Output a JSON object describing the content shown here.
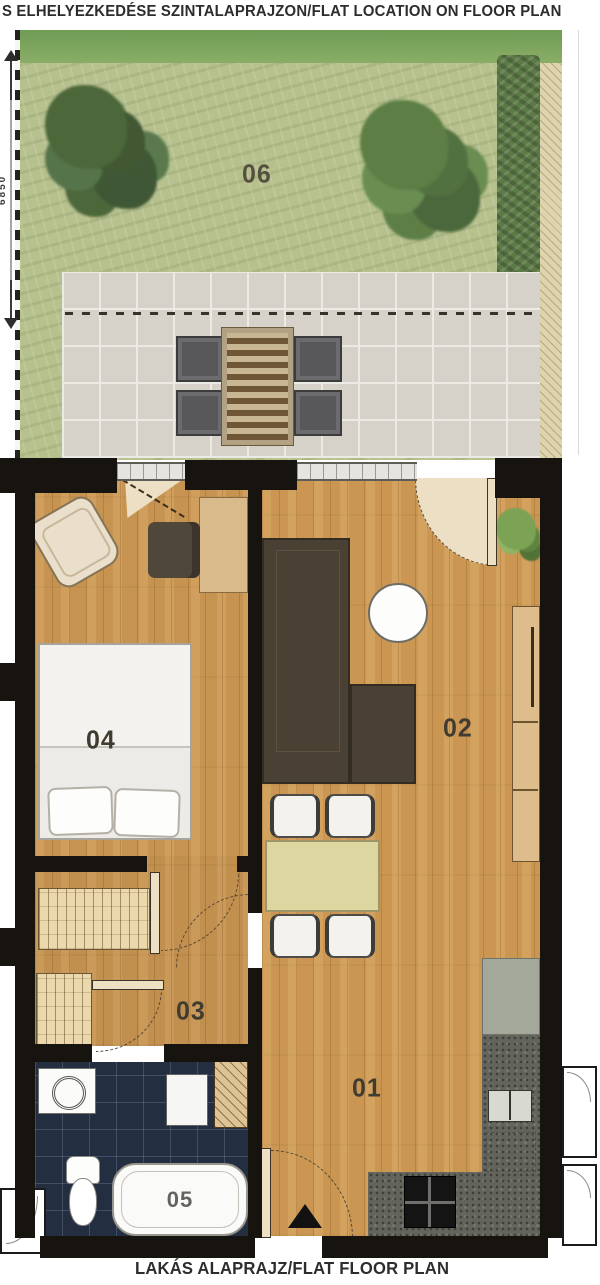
{
  "header": {
    "title": "S ELHELYEZKEDÉSE SZINTALAPRAJZON/FLAT LOCATION ON FLOOR PLAN"
  },
  "footer": {
    "title": "LAKÁS ALAPRAJZ/FLAT FLOOR PLAN"
  },
  "garden": {
    "dimension_label": "6850"
  },
  "rooms": {
    "kitchen_entry": {
      "label": "01"
    },
    "living": {
      "label": "02"
    },
    "hall": {
      "label": "03"
    },
    "bedroom": {
      "label": "04"
    },
    "bathroom": {
      "label": "05"
    },
    "garden": {
      "label": "06"
    }
  },
  "palette": {
    "wall": "#17130f",
    "wood_floor": "#c79350",
    "terrace_tile": "#d6d2ca",
    "grass": "#b7c18e",
    "bath_tile": "#232e41",
    "kitchen_counter": "#63655c",
    "dining_table": "#ddd6a0",
    "sofa": "#4a4134"
  }
}
